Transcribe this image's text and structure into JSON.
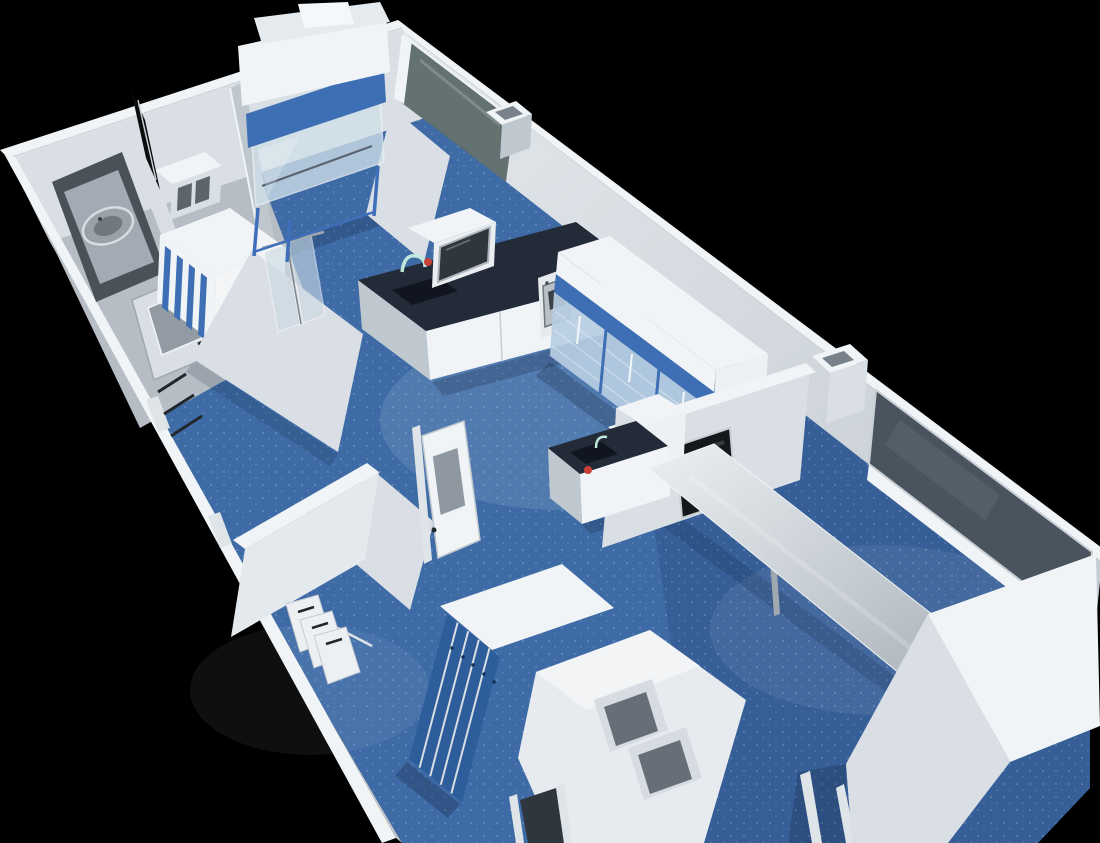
{
  "meta": {
    "title": "3D laboratory floor plan render",
    "description": "Isometric cutaway 3D rendering of a modular laboratory suite seen from above on a black background: blue vinyl floors, white partition walls, a glazed partition, a biosafety cabinet on a stand, lab benches with dark worktops and sinks, glass-door refrigerated cabinets, a sterilizer oven, a stainless steel work table, a wall-mounted display, blue garment lockers, pass-through hatches, lab coats on a rail, an autoclave viewport and interlock doors with viewing windows."
  },
  "palette": {
    "background": "#000000",
    "floor_blue": "#3e6ba6",
    "floor_blue_deep": "#2c4f86",
    "floor_speckle": "#b9d0ea",
    "floor_gray": "#b6bdc5",
    "wall_lightest": "#f1f4f6",
    "wall_light": "#d9dfe4",
    "wall_mid": "#bfc7cf",
    "wall_dark": "#a2abb4",
    "counter_navy": "#232a38",
    "counter_navy_dark": "#10151f",
    "accent_blue": "#3e6fb4",
    "locker_blue": "#2e5d9b",
    "stand_blue": "#3f6fba",
    "glass_partition": "#5e6c6c",
    "window_glass": "#4a545e",
    "glass_light": "#cfdfe9",
    "fridge_glass": "#b7cde2",
    "steel_light": "#dfe4e8",
    "steel_dark": "#a0a8b0",
    "red_accent": "#c94038",
    "teal_accent": "#bfe7da",
    "coat_white": "#edf0f2",
    "dark_detail": "#22272d",
    "shadow": "#0a1526"
  },
  "objects": [
    {
      "id": "building-shell",
      "label": "Laboratory building shell with white exterior walls"
    },
    {
      "id": "biosafety-cabinet",
      "label": "Biosafety cabinet with blue stripe on tubular stand"
    },
    {
      "id": "lab-bench-sink",
      "label": "Lab bench with dark worktop, sink and gooseneck faucet"
    },
    {
      "id": "benchtop-instrument",
      "label": "Benchtop instrument with glass door"
    },
    {
      "id": "sterilizer-oven",
      "label": "Sterilizer oven"
    },
    {
      "id": "refrigerated-cabinets",
      "label": "Tall glass-door refrigerated cabinets with blue frames"
    },
    {
      "id": "glass-partition",
      "label": "Dark glazed partition panel"
    },
    {
      "id": "exterior-window",
      "label": "Large dark exterior window"
    },
    {
      "id": "wall-monitor",
      "label": "Wall-mounted display screen"
    },
    {
      "id": "stainless-table",
      "label": "Long stainless steel work table"
    },
    {
      "id": "prep-bench",
      "label": "Prep counter with sink and red valve"
    },
    {
      "id": "garment-lockers",
      "label": "Blue garment locker bank with white top"
    },
    {
      "id": "pass-through",
      "label": "Pass-through hatch block with two openings"
    },
    {
      "id": "lab-coats",
      "label": "White lab coats hanging on rail"
    },
    {
      "id": "autoclave-viewport",
      "label": "Autoclave door with oval viewport"
    },
    {
      "id": "hvac-unit",
      "label": "White ventilation unit with blue fins"
    },
    {
      "id": "interlock-doors",
      "label": "Interlock doors with viewing windows"
    },
    {
      "id": "side-cabinet",
      "label": "Large white storage cabinet"
    }
  ]
}
